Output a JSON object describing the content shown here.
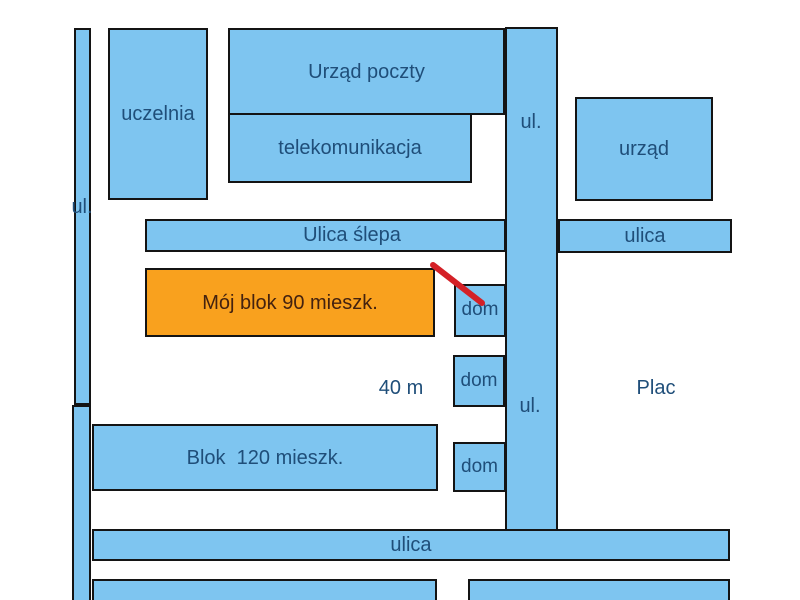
{
  "map": {
    "buildings": {
      "uczelnia": "uczelnia",
      "post_office": "Urząd poczty",
      "telecom": "telekomunikacja",
      "office": "urząd",
      "my_block": "Mój blok 90 mieszk.",
      "block_120": "Blok  120 mieszk.",
      "houses": [
        "dom",
        "dom",
        "dom"
      ]
    },
    "streets": {
      "left_vertical": "ul.",
      "center_vertical_top": "ul.",
      "center_vertical_mid": "ul.",
      "dead_end": "Ulica ślepa",
      "right_horizontal": "ulica",
      "bottom_horizontal": "ulica"
    },
    "annotations": {
      "distance": "40 m",
      "square": "Plac"
    },
    "colors": {
      "building_fill": "#7EC5F0",
      "highlight_fill": "#F9A11E",
      "outline": "#141414",
      "label_text": "#1F4E79",
      "highlight_text": "#44220F",
      "pointer_line": "#D42127"
    }
  }
}
